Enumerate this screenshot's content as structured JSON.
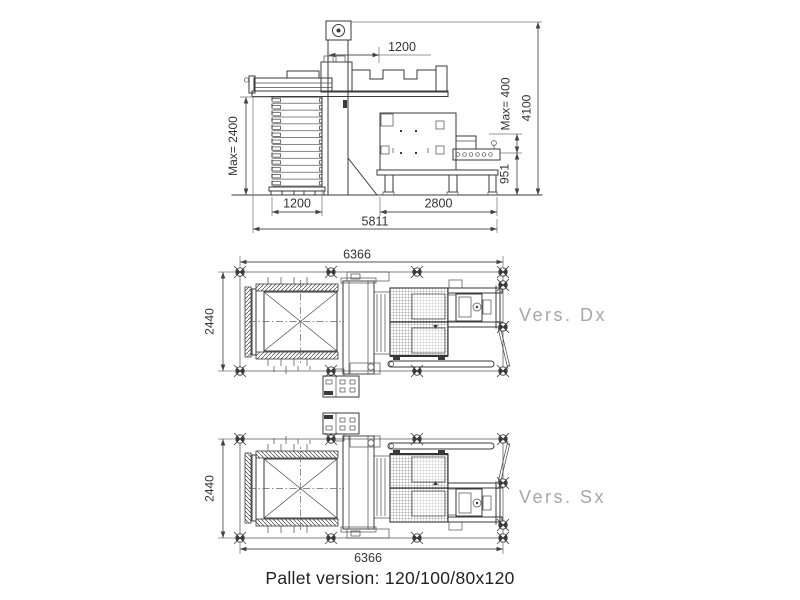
{
  "side_view": {
    "arm_stroke": "1200",
    "stack_max_height": "Max= 2400",
    "product_max_height": "Max= 400",
    "total_height": "4100",
    "conveyor_height": "951",
    "pallet_width": "1200",
    "machine_length": "2800",
    "total_length": "5811"
  },
  "plan_dx": {
    "label": "Vers. Dx",
    "length": "6366",
    "width": "2440"
  },
  "plan_sx": {
    "label": "Vers. Sx",
    "length": "6366",
    "width": "2440"
  },
  "caption": "Pallet version: 120/100/80x120",
  "colors": {
    "line": "#3a3a3a",
    "dimension": "#444444",
    "version_label": "#a6a6a6",
    "caption_text": "#222222",
    "background": "#ffffff"
  }
}
